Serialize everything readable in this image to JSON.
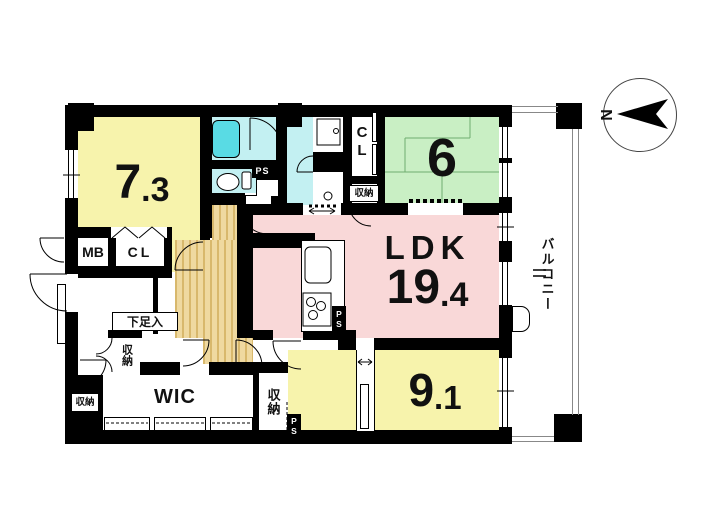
{
  "floor_plan": {
    "compass": {
      "north": "N"
    },
    "balcony": {
      "label": "バルコニー"
    },
    "rooms": {
      "bedroom_1": {
        "num": "7",
        "dec": ".3"
      },
      "tatami": {
        "num": "6"
      },
      "ldk": {
        "name": "LDK",
        "num": "19",
        "dec": ".4"
      },
      "bedroom_2": {
        "num": "9",
        "dec": ".1"
      },
      "wic": {
        "label": "WIC"
      }
    },
    "closets": {
      "mb": "MB",
      "cl_entry": "CL",
      "cl_hall": "CL",
      "storage_a": "収納",
      "storage_b": "収納",
      "storage_c": "収納",
      "storage_d": "収納",
      "shoe_cabinet": "下足入"
    },
    "ps": "PS",
    "colors": {
      "room_yellow": "#f7f3ac",
      "tatami_green": "#c9efc4",
      "ldk_pink": "#f9d8d8",
      "wet_cyan": "#c3f0f2",
      "tub_cyan": "#59dbe4",
      "hall_tan": "#efd9a0",
      "hall_stripe": "#d8b86c",
      "wall": "#000000"
    }
  }
}
